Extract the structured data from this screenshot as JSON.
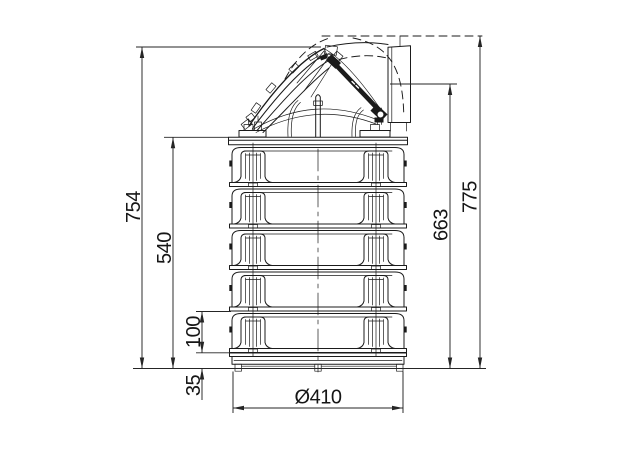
{
  "colors": {
    "background": "#ffffff",
    "line": "#1b1b1b",
    "dimension": "#252525"
  },
  "dimensions": {
    "d754": "754",
    "d540": "540",
    "d100": "100",
    "d35": "35",
    "d663": "663",
    "d775": "775",
    "d410": "Ø410"
  }
}
